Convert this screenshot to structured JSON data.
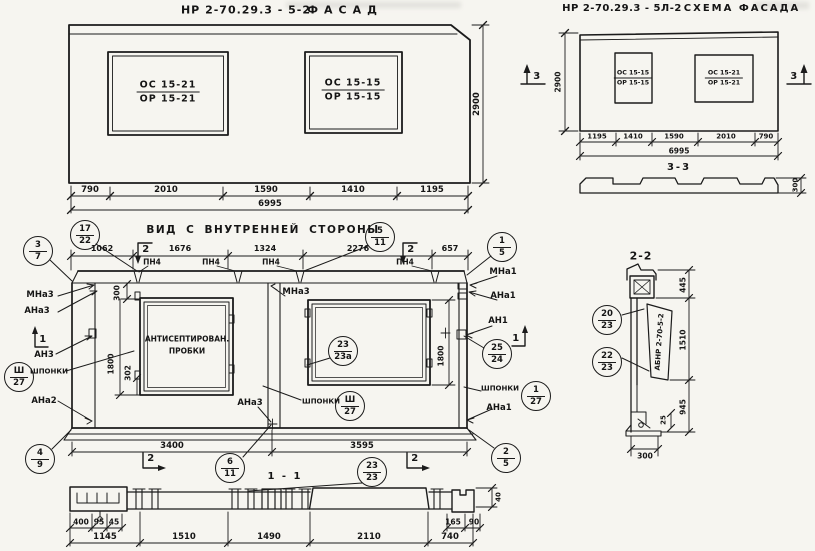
{
  "facade": {
    "code": "НР 2-70.29.3 - 5-2",
    "name": "ФАСАД",
    "win_left": {
      "top": "ОС 15-21",
      "bot": "ОР 15-21"
    },
    "win_right": {
      "top": "ОС 15-15",
      "bot": "ОР 15-15"
    },
    "dims": [
      "790",
      "2010",
      "1590",
      "1410",
      "1195"
    ],
    "total": "6995",
    "height": "2900"
  },
  "schema": {
    "code": "НР 2-70.29.3 - 5Л-2",
    "name": "СХЕМА ФАСАДА",
    "win_left": {
      "top": "ОС 15-15",
      "bot": "ОР 15-15"
    },
    "win_right": {
      "top": "ОС 15-21",
      "bot": "ОР 15-21"
    },
    "dims": [
      "1195",
      "1410",
      "1590",
      "2010",
      "790"
    ],
    "total": "6995",
    "height": "2900",
    "marker": "3",
    "section_label": "3-3",
    "profile_height": "300"
  },
  "inner": {
    "title": "ВИД С ВНУТРЕННЕЙ СТОРОНЫ",
    "top_dims": [
      "1062",
      "1676",
      "1324",
      "2276",
      "657"
    ],
    "pn": [
      "ПН4",
      "ПН4",
      "ПН4",
      "ПН4"
    ],
    "note1": "АНТИСЕПТИРОВАН.",
    "note2": "ПРОБКИ",
    "flag1": "1",
    "flag2": "2",
    "left_labels": {
      "mna3": "МНа3",
      "ana3": "АНа3",
      "an3": "АН3",
      "shponki": "ШПОНКИ",
      "ana2": "АНа2"
    },
    "mid_labels": {
      "mna3": "МНа3",
      "ana3": "АНа3",
      "shponki": "ШПОНКИ"
    },
    "right_labels": {
      "mna1": "МНа1",
      "ana1": "АНа1",
      "an1": "АН1",
      "shponki": "ШПОНКИ",
      "ana1b": "АНа1"
    },
    "callouts": {
      "c3_7": {
        "t": "3",
        "b": "7"
      },
      "c17_22": {
        "t": "17",
        "b": "22"
      },
      "c5_11": {
        "t": "5",
        "b": "11"
      },
      "c1_5": {
        "t": "1",
        "b": "5"
      },
      "csh27l": {
        "t": "Ш",
        "b": "27"
      },
      "c4_9": {
        "t": "4",
        "b": "9"
      },
      "c6_11": {
        "t": "6",
        "b": "11"
      },
      "c23_23a": {
        "t": "23",
        "b": "23а"
      },
      "csh27m": {
        "t": "Ш",
        "b": "27"
      },
      "c25_24": {
        "t": "25",
        "b": "24"
      },
      "c1_27": {
        "t": "1",
        "b": "27"
      },
      "c2_5": {
        "t": "2",
        "b": "5"
      }
    },
    "vdims": {
      "v300": "300",
      "v1800l": "1800",
      "v302": "302",
      "v1800r": "1800"
    },
    "bottom_dims": [
      "3400",
      "3595"
    ]
  },
  "sec11": {
    "label": "1 - 1",
    "c23_23": {
      "t": "23",
      "b": "23"
    },
    "row1_left": [
      "400",
      "95",
      "45"
    ],
    "row1_right": [
      "165",
      "90"
    ],
    "row2": [
      "1145",
      "1510",
      "1490",
      "2110",
      "740"
    ],
    "v40": "40"
  },
  "sec22": {
    "title": "2-2",
    "c20_23": {
      "t": "20",
      "b": "23"
    },
    "c22_23": {
      "t": "22",
      "b": "23"
    },
    "stamp": "АБНР 2-70-5-2",
    "d445": "445",
    "d1510": "1510",
    "d945": "945",
    "d25": "25",
    "d300": "300"
  }
}
